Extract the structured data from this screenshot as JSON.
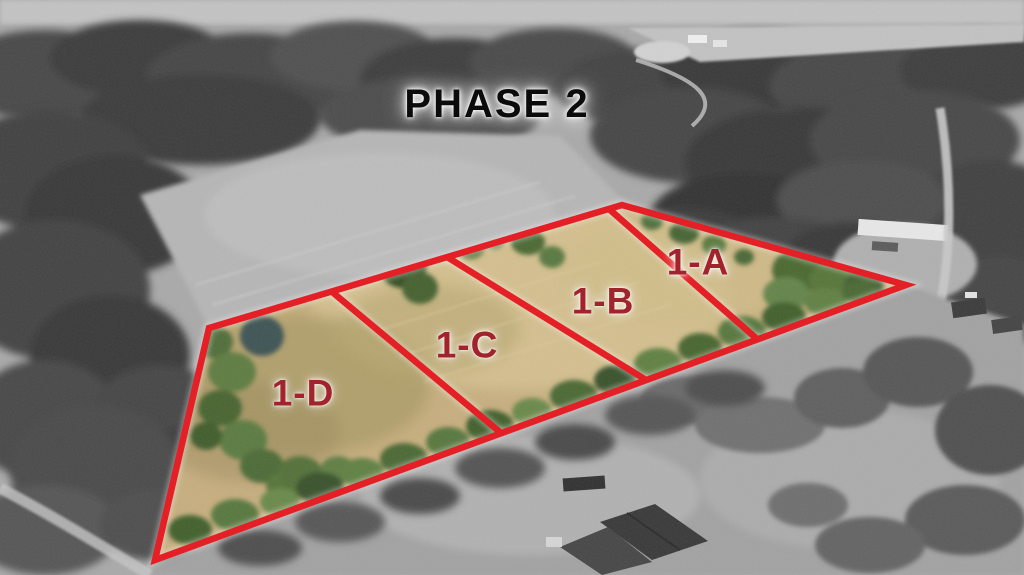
{
  "overlay": {
    "phase_label": "PHASE 2",
    "lots": [
      {
        "id": "1-A"
      },
      {
        "id": "1-B"
      },
      {
        "id": "1-C"
      },
      {
        "id": "1-D"
      }
    ]
  },
  "colors": {
    "boundary_red": "#e42026",
    "lot_label_red": "#a1232b",
    "phase_text": "#0b0b0b"
  }
}
